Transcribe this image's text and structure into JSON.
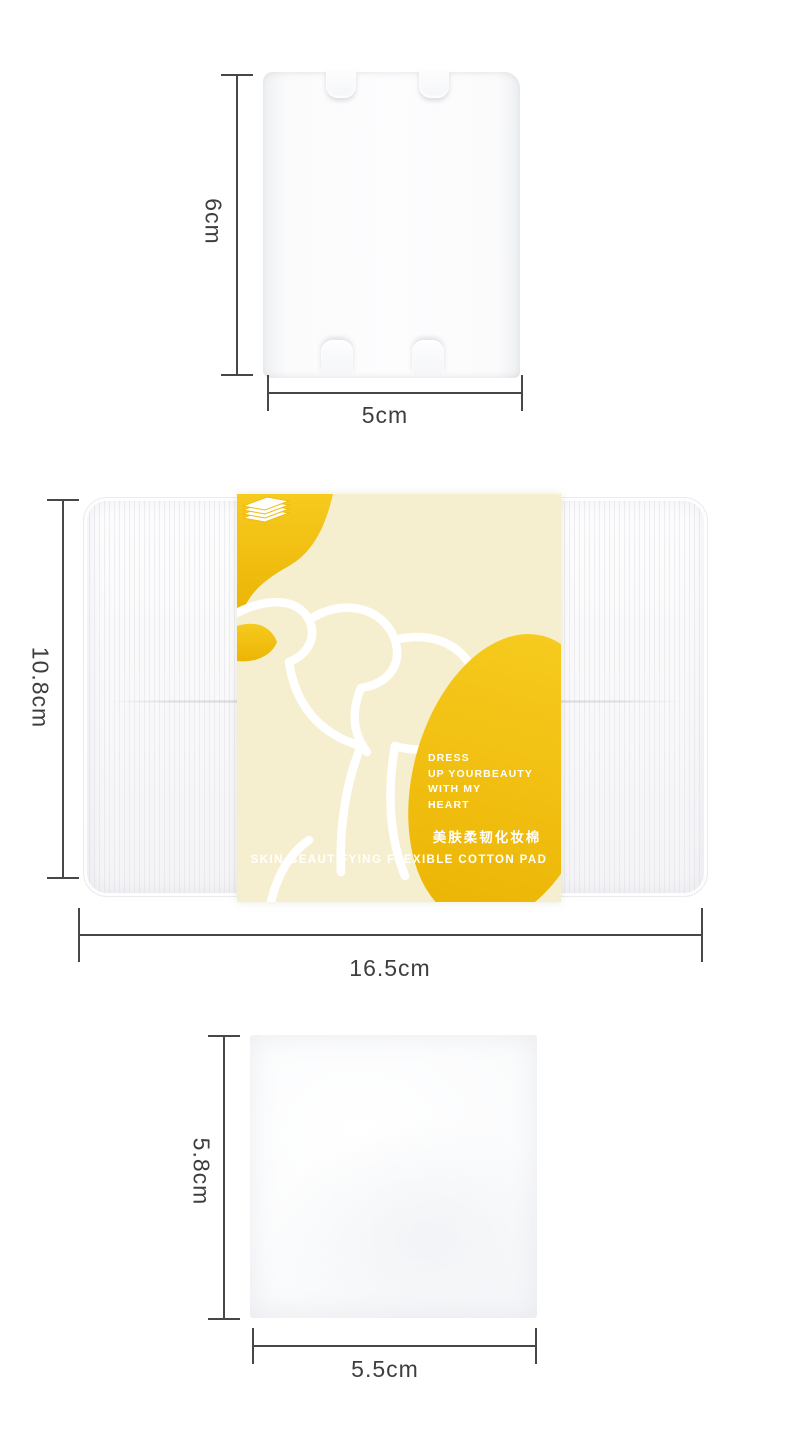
{
  "page": {
    "background": "#ffffff"
  },
  "palette": {
    "gold": "#f0bf10",
    "gold_light": "#f6ca1e",
    "gold_deep": "#ecb505",
    "cream": "#f6efcf",
    "measure_line": "#474747",
    "measure_text": "#3e3e3e",
    "band_text": "#ffffff"
  },
  "shots": {
    "single_pad": {
      "height_label": "6cm",
      "width_label": "5cm"
    },
    "box_pack": {
      "height_label": "10.8cm",
      "width_label": "16.5cm",
      "band": {
        "tagline": [
          "DRESS",
          "UP YOURBEAUTY",
          "WITH MY",
          "HEART"
        ],
        "chinese_label": "美肤柔韧化妆棉",
        "english_label": "SKIN-BEAUTIFYING FLEXIBLE COTTON PAD",
        "icon": "cotton-pad-stack-icon"
      }
    },
    "square_pad": {
      "height_label": "5.8cm",
      "width_label": "5.5cm"
    }
  }
}
